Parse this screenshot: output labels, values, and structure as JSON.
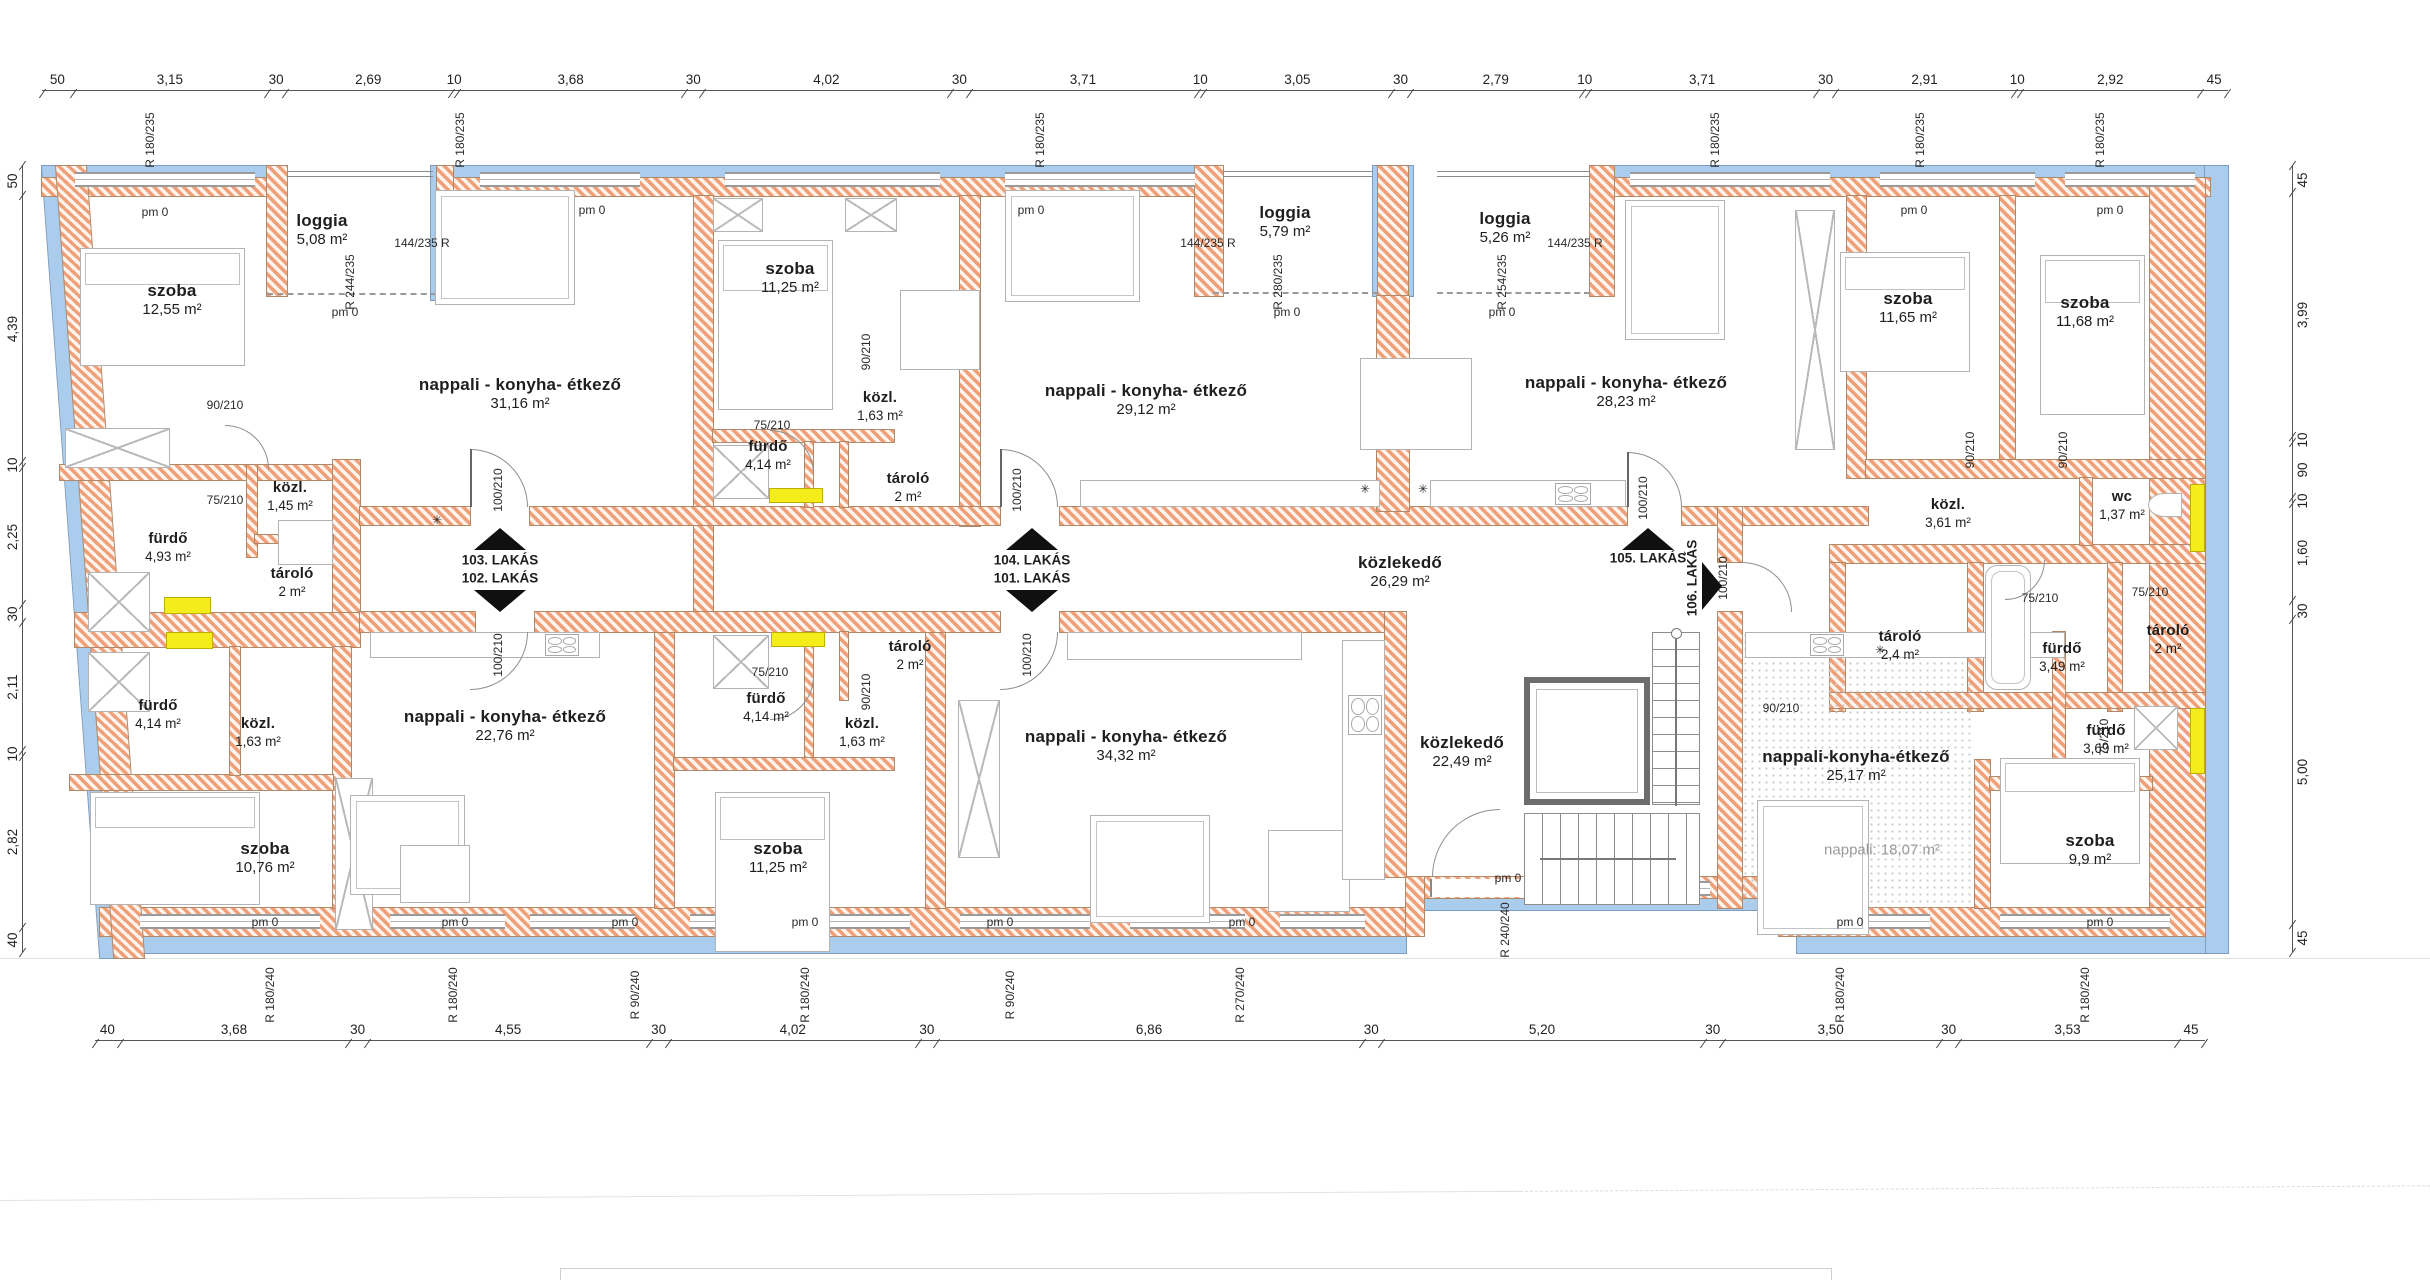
{
  "meta": {
    "type": "floor-plan",
    "language": "hu",
    "units": "m"
  },
  "colors": {
    "wall_hatch": "#f0a078",
    "wall_bg": "#fdf4ed",
    "insulation": "#abcded",
    "highlight": "#f4ed1b",
    "line": "#444444",
    "text": "#1e1e1e",
    "furniture_line": "#b3b3b3",
    "stair_line": "#8c8c8c"
  },
  "rooms": [
    {
      "n": "szoba",
      "a": "12,55 m²",
      "x": 172,
      "y": 300
    },
    {
      "n": "loggia",
      "a": "5,08 m²",
      "x": 322,
      "y": 230
    },
    {
      "n": "nappali - konyha- étkező",
      "a": "31,16 m²",
      "x": 520,
      "y": 394
    },
    {
      "n": "szoba",
      "a": "11,25 m²",
      "x": 790,
      "y": 278
    },
    {
      "n": "fürdő",
      "a": "4,93 m²",
      "x": 168,
      "y": 548,
      "s": 1
    },
    {
      "n": "közl.",
      "a": "1,45 m²",
      "x": 290,
      "y": 497,
      "s": 1
    },
    {
      "n": "tároló",
      "a": "2 m²",
      "x": 292,
      "y": 583,
      "s": 1
    },
    {
      "n": "fürdő",
      "a": "4,14 m²",
      "x": 768,
      "y": 456,
      "s": 1
    },
    {
      "n": "közl.",
      "a": "1,63 m²",
      "x": 880,
      "y": 407,
      "s": 1
    },
    {
      "n": "tároló",
      "a": "2 m²",
      "x": 908,
      "y": 488,
      "s": 1
    },
    {
      "n": "nappali - konyha- étkező",
      "a": "29,12 m²",
      "x": 1146,
      "y": 400
    },
    {
      "n": "loggia",
      "a": "5,79 m²",
      "x": 1285,
      "y": 222
    },
    {
      "n": "loggia",
      "a": "5,26 m²",
      "x": 1505,
      "y": 228
    },
    {
      "n": "nappali - konyha- étkező",
      "a": "28,23 m²",
      "x": 1626,
      "y": 392
    },
    {
      "n": "szoba",
      "a": "11,65 m²",
      "x": 1908,
      "y": 308
    },
    {
      "n": "szoba",
      "a": "11,68 m²",
      "x": 2085,
      "y": 312
    },
    {
      "n": "közl.",
      "a": "3,61 m²",
      "x": 1948,
      "y": 514,
      "s": 1
    },
    {
      "n": "wc",
      "a": "1,37 m²",
      "x": 2122,
      "y": 506,
      "s": 1
    },
    {
      "n": "közlekedő",
      "a": "26,29 m²",
      "x": 1400,
      "y": 572
    },
    {
      "n": "tároló",
      "a": "2,4 m²",
      "x": 1900,
      "y": 646,
      "s": 1
    },
    {
      "n": "fürdő",
      "a": "3,49 m²",
      "x": 2062,
      "y": 658,
      "s": 1
    },
    {
      "n": "tároló",
      "a": "2 m²",
      "x": 2168,
      "y": 640,
      "s": 1
    },
    {
      "n": "fürdő",
      "a": "4,14 m²",
      "x": 158,
      "y": 715,
      "s": 1
    },
    {
      "n": "közl.",
      "a": "1,63 m²",
      "x": 258,
      "y": 733,
      "s": 1
    },
    {
      "n": "szoba",
      "a": "10,76 m²",
      "x": 265,
      "y": 858
    },
    {
      "n": "nappali - konyha- étkező",
      "a": "22,76 m²",
      "x": 505,
      "y": 726
    },
    {
      "n": "szoba",
      "a": "11,25 m²",
      "x": 778,
      "y": 858
    },
    {
      "n": "tároló",
      "a": "2 m²",
      "x": 910,
      "y": 656,
      "s": 1
    },
    {
      "n": "fürdő",
      "a": "4,14 m²",
      "x": 766,
      "y": 708,
      "s": 1
    },
    {
      "n": "közl.",
      "a": "1,63 m²",
      "x": 862,
      "y": 733,
      "s": 1
    },
    {
      "n": "nappali - konyha- étkező",
      "a": "34,32 m²",
      "x": 1126,
      "y": 746
    },
    {
      "n": "közlekedő",
      "a": "22,49 m²",
      "x": 1462,
      "y": 752
    },
    {
      "n": "nappali-konyha-étkező",
      "a": "25,17 m²",
      "x": 1856,
      "y": 766
    },
    {
      "n": "",
      "a": "nappali: 18,07 m²",
      "x": 1882,
      "y": 851,
      "s": 3
    },
    {
      "n": "fürdő",
      "a": "3,69 m²",
      "x": 2106,
      "y": 740,
      "s": 1
    },
    {
      "n": "szoba",
      "a": "9,9 m²",
      "x": 2090,
      "y": 850
    }
  ],
  "entries": {
    "pair1_top": "103. LAKÁS",
    "pair1_bottom": "102. LAKÁS",
    "pair2_top": "104. LAKÁS",
    "pair2_bottom": "101. LAKÁS",
    "single_up": "105. LAKÁS",
    "single_right": "106. LAKÁS"
  },
  "dimensions": {
    "top": [
      {
        "t": "50",
        "w": 0.5
      },
      {
        "t": "3,15",
        "w": 3.15
      },
      {
        "t": "30",
        "w": 0.3
      },
      {
        "t": "2,69",
        "w": 2.69
      },
      {
        "t": "10",
        "w": 0.1
      },
      {
        "t": "3,68",
        "w": 3.68
      },
      {
        "t": "30",
        "w": 0.3
      },
      {
        "t": "4,02",
        "w": 4.02
      },
      {
        "t": "30",
        "w": 0.3
      },
      {
        "t": "3,71",
        "w": 3.71
      },
      {
        "t": "10",
        "w": 0.1
      },
      {
        "t": "3,05",
        "w": 3.05
      },
      {
        "t": "30",
        "w": 0.3
      },
      {
        "t": "2,79",
        "w": 2.79
      },
      {
        "t": "10",
        "w": 0.1
      },
      {
        "t": "3,71",
        "w": 3.71
      },
      {
        "t": "30",
        "w": 0.3
      },
      {
        "t": "2,91",
        "w": 2.91
      },
      {
        "t": "10",
        "w": 0.1
      },
      {
        "t": "2,92",
        "w": 2.92
      },
      {
        "t": "45",
        "w": 0.45
      }
    ],
    "bottom": [
      {
        "t": "40",
        "w": 0.4
      },
      {
        "t": "3,68",
        "w": 3.68
      },
      {
        "t": "30",
        "w": 0.3
      },
      {
        "t": "4,55",
        "w": 4.55
      },
      {
        "t": "30",
        "w": 0.3
      },
      {
        "t": "4,02",
        "w": 4.02
      },
      {
        "t": "30",
        "w": 0.3
      },
      {
        "t": "6,86",
        "w": 6.86
      },
      {
        "t": "30",
        "w": 0.3
      },
      {
        "t": "5,20",
        "w": 5.2
      },
      {
        "t": "30",
        "w": 0.3
      },
      {
        "t": "3,50",
        "w": 3.5
      },
      {
        "t": "30",
        "w": 0.3
      },
      {
        "t": "3,53",
        "w": 3.53
      },
      {
        "t": "45",
        "w": 0.45
      }
    ],
    "left": [
      {
        "t": "50",
        "w": 0.5
      },
      {
        "t": "4,39",
        "w": 4.39
      },
      {
        "t": "10",
        "w": 0.1
      },
      {
        "t": "2,25",
        "w": 2.25
      },
      {
        "t": "30",
        "w": 0.3
      },
      {
        "t": "2,11",
        "w": 2.11
      },
      {
        "t": "10",
        "w": 0.1
      },
      {
        "t": "2,82",
        "w": 2.82
      },
      {
        "t": "40",
        "w": 0.4
      }
    ],
    "right": [
      {
        "t": "45",
        "w": 0.45
      },
      {
        "t": "3,99",
        "w": 3.99
      },
      {
        "t": "10",
        "w": 0.1
      },
      {
        "t": "90",
        "w": 0.9
      },
      {
        "t": "10",
        "w": 0.1
      },
      {
        "t": "1,60",
        "w": 1.6
      },
      {
        "t": "30",
        "w": 0.3
      },
      {
        "t": "5,00",
        "w": 5.0
      },
      {
        "t": "45",
        "w": 0.45
      }
    ]
  },
  "annotations": [
    {
      "t": "R 180/235",
      "x": 150,
      "y": 140,
      "r": -90
    },
    {
      "t": "R 180/235",
      "x": 460,
      "y": 140,
      "r": -90
    },
    {
      "t": "R 180/235",
      "x": 1040,
      "y": 140,
      "r": -90
    },
    {
      "t": "R 180/235",
      "x": 1715,
      "y": 140,
      "r": -90
    },
    {
      "t": "R 180/235",
      "x": 1920,
      "y": 140,
      "r": -90
    },
    {
      "t": "R 180/235",
      "x": 2100,
      "y": 140,
      "r": -90
    },
    {
      "t": "R 244/235",
      "x": 350,
      "y": 282,
      "r": -90
    },
    {
      "t": "144/235 R",
      "x": 422,
      "y": 243,
      "r": 0
    },
    {
      "t": "144/235 R",
      "x": 1208,
      "y": 243,
      "r": 0
    },
    {
      "t": "144/235 R",
      "x": 1575,
      "y": 243,
      "r": 0
    },
    {
      "t": "R 280/235",
      "x": 1278,
      "y": 282,
      "r": -90
    },
    {
      "t": "R 254/235",
      "x": 1502,
      "y": 282,
      "r": -90
    },
    {
      "t": "pm 0",
      "x": 155,
      "y": 212,
      "r": 0
    },
    {
      "t": "pm 0",
      "x": 592,
      "y": 210,
      "r": 0
    },
    {
      "t": "pm 0",
      "x": 1031,
      "y": 210,
      "r": 0
    },
    {
      "t": "pm 0",
      "x": 1914,
      "y": 210,
      "r": 0
    },
    {
      "t": "pm 0",
      "x": 2110,
      "y": 210,
      "r": 0
    },
    {
      "t": "pm 0",
      "x": 345,
      "y": 312,
      "r": 0
    },
    {
      "t": "pm 0",
      "x": 1287,
      "y": 312,
      "r": 0
    },
    {
      "t": "pm 0",
      "x": 1502,
      "y": 312,
      "r": 0
    },
    {
      "t": "pm 0",
      "x": 265,
      "y": 922,
      "r": 0
    },
    {
      "t": "pm 0",
      "x": 455,
      "y": 922,
      "r": 0
    },
    {
      "t": "pm 0",
      "x": 625,
      "y": 922,
      "r": 0
    },
    {
      "t": "pm 0",
      "x": 805,
      "y": 922,
      "r": 0
    },
    {
      "t": "pm 0",
      "x": 1000,
      "y": 922,
      "r": 0
    },
    {
      "t": "pm 0",
      "x": 1242,
      "y": 922,
      "r": 0
    },
    {
      "t": "pm 0",
      "x": 1850,
      "y": 922,
      "r": 0
    },
    {
      "t": "pm 0",
      "x": 2100,
      "y": 922,
      "r": 0
    },
    {
      "t": "pm 0",
      "x": 1508,
      "y": 878,
      "r": 0
    },
    {
      "t": "R 180/240",
      "x": 270,
      "y": 995,
      "r": -90
    },
    {
      "t": "R 180/240",
      "x": 453,
      "y": 995,
      "r": -90
    },
    {
      "t": "R 180/240",
      "x": 805,
      "y": 995,
      "r": -90
    },
    {
      "t": "R 180/240",
      "x": 1840,
      "y": 995,
      "r": -90
    },
    {
      "t": "R 180/240",
      "x": 2085,
      "y": 995,
      "r": -90
    },
    {
      "t": "R 90/240",
      "x": 635,
      "y": 995,
      "r": -90
    },
    {
      "t": "R 90/240",
      "x": 1010,
      "y": 995,
      "r": -90
    },
    {
      "t": "R 270/240",
      "x": 1240,
      "y": 995,
      "r": -90
    },
    {
      "t": "R 240/240",
      "x": 1505,
      "y": 930,
      "r": -90
    },
    {
      "t": "90/210",
      "x": 225,
      "y": 405,
      "r": 0
    },
    {
      "t": "90/210",
      "x": 866,
      "y": 352,
      "r": -90
    },
    {
      "t": "90/210",
      "x": 866,
      "y": 692,
      "r": -90
    },
    {
      "t": "90/210",
      "x": 1781,
      "y": 708,
      "r": 0
    },
    {
      "t": "90/210",
      "x": 1970,
      "y": 450,
      "r": -90
    },
    {
      "t": "90/210",
      "x": 2063,
      "y": 450,
      "r": -90
    },
    {
      "t": "75/210",
      "x": 225,
      "y": 500,
      "r": 0
    },
    {
      "t": "75/210",
      "x": 772,
      "y": 425,
      "r": 0
    },
    {
      "t": "75/210",
      "x": 770,
      "y": 672,
      "r": 0
    },
    {
      "t": "75/210",
      "x": 2040,
      "y": 598,
      "r": 0
    },
    {
      "t": "75/210",
      "x": 2150,
      "y": 592,
      "r": 0
    },
    {
      "t": "75/210",
      "x": 2104,
      "y": 737,
      "r": -90
    },
    {
      "t": "100/210",
      "x": 498,
      "y": 490,
      "r": -90
    },
    {
      "t": "100/210",
      "x": 1017,
      "y": 490,
      "r": -90
    },
    {
      "t": "100/210",
      "x": 498,
      "y": 655,
      "r": -90
    },
    {
      "t": "100/210",
      "x": 1027,
      "y": 655,
      "r": -90
    },
    {
      "t": "100/210",
      "x": 1643,
      "y": 498,
      "r": -90
    },
    {
      "t": "100/210",
      "x": 1723,
      "y": 578,
      "r": -90
    },
    {
      "t": "✳",
      "x": 437,
      "y": 520,
      "r": 0
    },
    {
      "t": "✳",
      "x": 1365,
      "y": 489,
      "r": 0
    },
    {
      "t": "✳",
      "x": 1423,
      "y": 489,
      "r": 0
    },
    {
      "t": "✳",
      "x": 1880,
      "y": 650,
      "r": 0
    }
  ]
}
